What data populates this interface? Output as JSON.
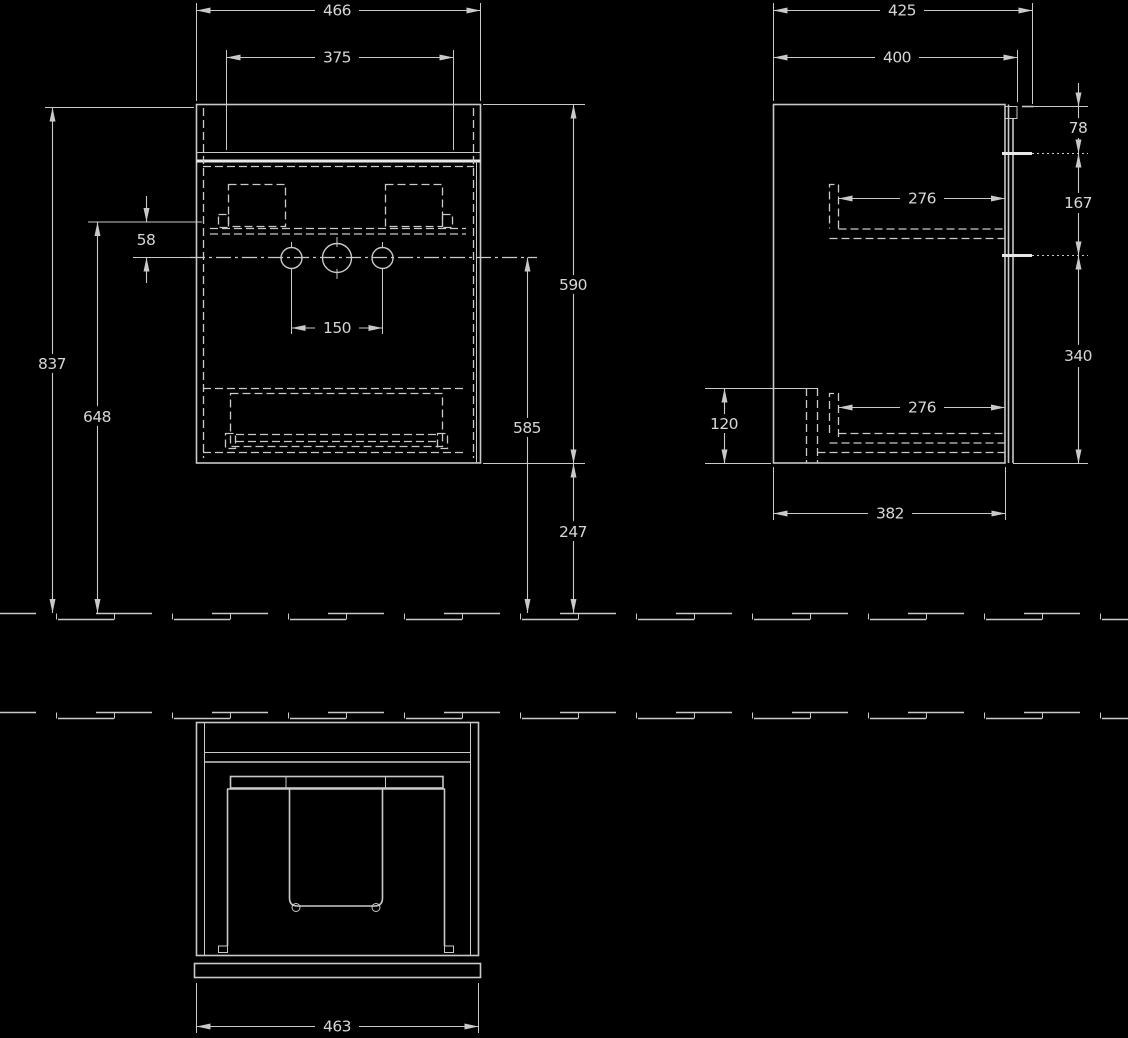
{
  "drawing_name": "wall-hung vanity unit technical drawing, three orthographic views",
  "colors": {
    "background": "#000000",
    "line": "#c9c9c9",
    "line_bright": "#e8e8e8",
    "text": "#d6d6d6"
  },
  "labels": {
    "front": {
      "d466": "466",
      "d375": "375",
      "d58": "58",
      "d837": "837",
      "d648": "648",
      "d150": "150",
      "d590": "590",
      "d585": "585",
      "d247": "247"
    },
    "side": {
      "d425": "425",
      "d400": "400",
      "d78": "78",
      "d167": "167",
      "d340": "340",
      "d276_top": "276",
      "d276_bottom": "276",
      "d120": "120",
      "d382": "382"
    },
    "plan": {
      "d463": "463"
    }
  }
}
